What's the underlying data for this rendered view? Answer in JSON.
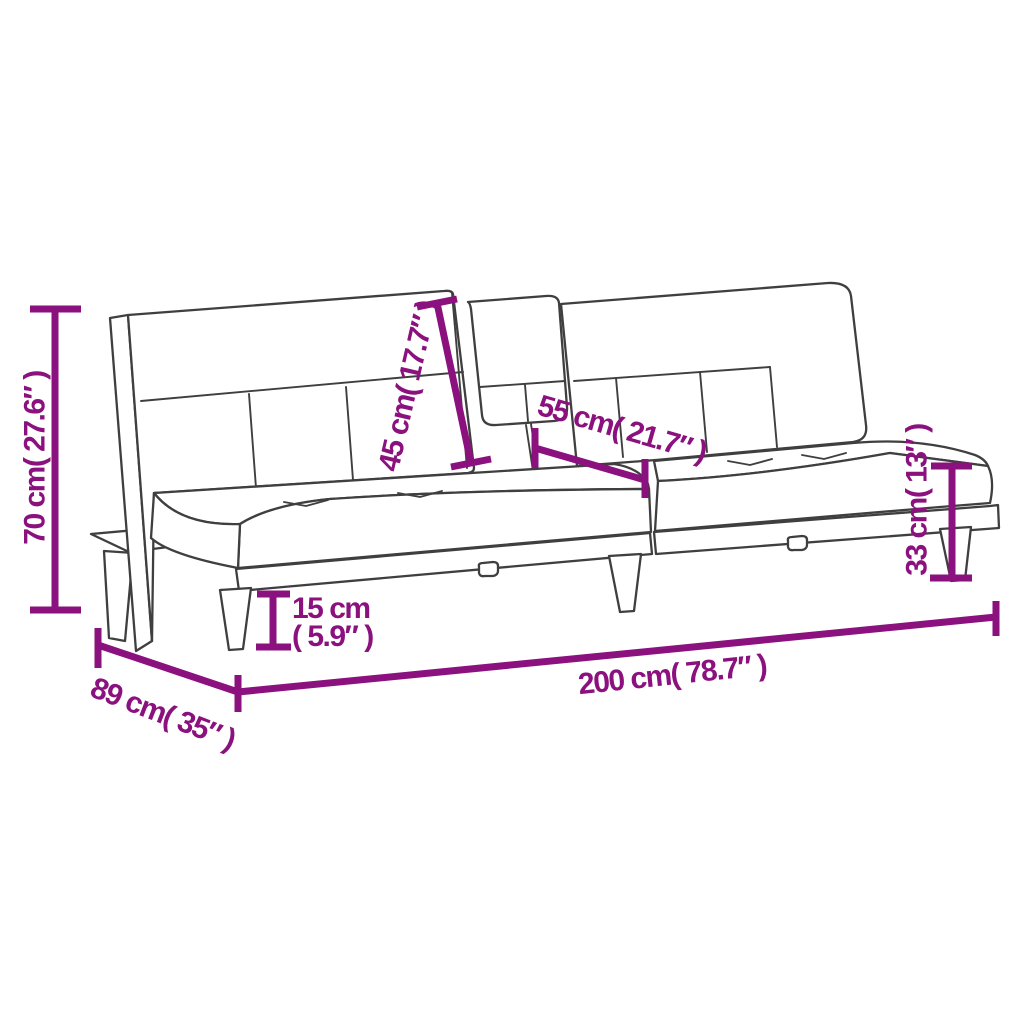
{
  "colors": {
    "dimension": "#8b117e",
    "line_art": "#3f3f3f",
    "background": "#ffffff"
  },
  "diagram": {
    "product": "sofa-bed-with-fold-down-table",
    "labels": {
      "overall_height": "70 cm( 27.6″ )",
      "backrest_table_length": "45 cm( 17.7″ )",
      "table_width": "55 cm( 21.7″ )",
      "seat_height": "33 cm( 13″ )",
      "leg_height_line1": "15 cm",
      "leg_height_line2": "( 5.9″ )",
      "depth": "89 cm( 35″ )",
      "overall_length": "200 cm( 78.7″ )"
    },
    "measurements": {
      "overall_height": {
        "cm": 70,
        "inches": 27.6
      },
      "backrest_table_length": {
        "cm": 45,
        "inches": 17.7
      },
      "table_width": {
        "cm": 55,
        "inches": 21.7
      },
      "seat_height": {
        "cm": 33,
        "inches": 13
      },
      "leg_height": {
        "cm": 15,
        "inches": 5.9
      },
      "depth": {
        "cm": 89,
        "inches": 35
      },
      "overall_length": {
        "cm": 200,
        "inches": 78.7
      }
    }
  }
}
